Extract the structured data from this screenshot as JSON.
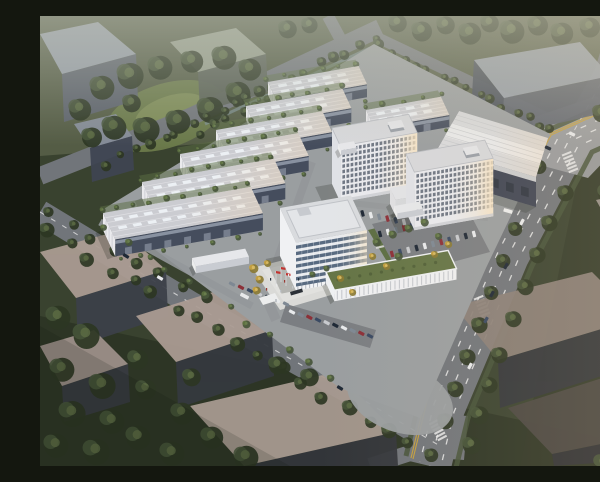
{
  "scene": {
    "description": "Aerial dusk rendering of an industrial business park: six staggered ribbed-roof warehouses plus one behind, two white high-rise dormitory slabs with sunlit facades, a glass-banded office tower fronted by a flag plaza with three red flags, a colonnaded podium with roof garden, and a large white logistics hall; the campus is ringed by tree-lined arterial roads with lane markings, parked cars, and translucent grey massing blocks of neighboring parcels.",
    "view": "aerial-oblique",
    "time_of_day": "dusk",
    "counts": {
      "warehouses": 7,
      "highrise_slabs": 2,
      "office_towers": 1,
      "logistics_halls": 1,
      "flag_poles": 3,
      "context_masses": 11
    }
  },
  "colors": {
    "ground": "#39422f",
    "ground_top": "#6f765c",
    "ground_dark": "#242b1e",
    "lawn_park": "#6c7a4b",
    "lawn_park_light": "#7e8c58",
    "tree_dark": "#2c3623",
    "tree_mid": "#46553a",
    "tree_light": "#5c6c44",
    "tree_bright": "#5f7342",
    "tree_autumn": "#c9a33f",
    "road": "#71757a",
    "road_light": "#9a9da0",
    "campus_ground": "#9a9ea0",
    "inner_road": "#94979a",
    "lane_white": "#e9eaea",
    "lane_yellow": "#c8a23c",
    "verge_green": "#46543a",
    "plaza": "#dadad7",
    "lawn": "#5c6e44",
    "parking": "#7b7e82",
    "context_top": "#99a1ab",
    "context_green_top": "#98a08f",
    "context_warm": "#ab9c93",
    "context_side": "#5d636e",
    "context_dark": "#3a3f48",
    "warehouse_roof": "#cbccd1",
    "warehouse_rib": "#e2e2e6",
    "warehouse_skylight": "#edf1f6",
    "warehouse_end": "#eaeaed",
    "warehouse_front": "#454d5d",
    "warehouse_band": "#99a3b1",
    "warehouse_door": "#7f8795",
    "hr_facade": "#e9eaee",
    "hr_end": "#dfe1e6",
    "hr_window": "#5d6675",
    "hr_roof": "#d7d8db",
    "office_spandrel": "#e9ebee",
    "office_end": "#f0f1f3",
    "office_glass": "#4c6077",
    "office_roof": "#d9dbde",
    "podium_wall": "#eff0f2",
    "podium_roof": "#657546",
    "bw_roof": "#d9dadc",
    "bw_band": "#eaebec",
    "bw_wall": "#3f4554",
    "bw_wall_band": "#d9dadb",
    "bw_wall_side": "#343b49",
    "shadow": "#161c12",
    "flag_red": "#c23430",
    "monument": "#2c3138",
    "truck_white": "#eceded",
    "water": "#7c8e91",
    "cars": [
      "#1f2936",
      "#e8eaec",
      "#7e8893",
      "#8c3038",
      "#3a4a63",
      "#c8cace"
    ]
  }
}
